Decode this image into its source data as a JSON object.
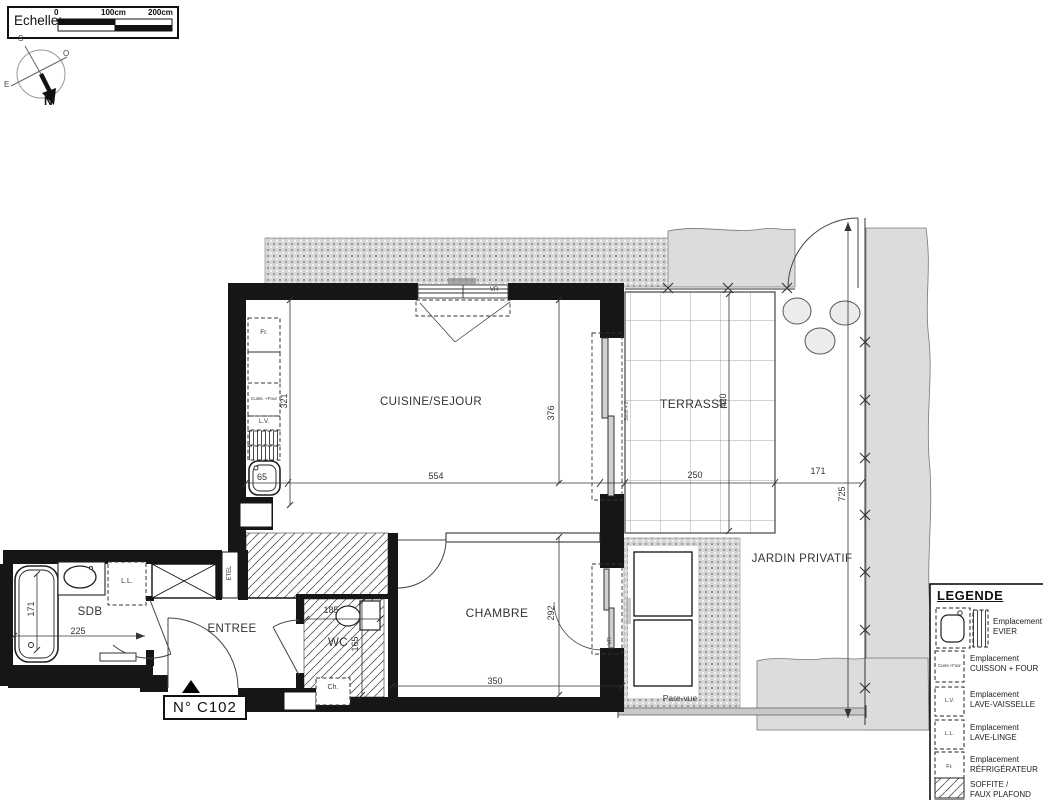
{
  "scale_widget": {
    "label": "Echelle:",
    "tick0": "0",
    "tick100": "100cm",
    "tick200": "200cm"
  },
  "compass": {
    "north": "N",
    "south": "S",
    "east": "E",
    "west": "O"
  },
  "unit_tag": {
    "number": "N° C102"
  },
  "rooms": {
    "cuisine_sejour": "CUISINE/SEJOUR",
    "terrasse": "TERRASSE",
    "chambre": "CHAMBRE",
    "wc": "WC",
    "entree": "ENTREE",
    "sdb": "SDB",
    "jardin_privatif": "JARDIN PRIVATIF"
  },
  "dims": {
    "kitchen_w": "554",
    "kitchen_h_left": "321",
    "kitchen_h_right": "376",
    "sink_w": "65",
    "terrasse_w": "250",
    "terrasse_h": "420",
    "jardin_w": "171",
    "jardin_h": "725",
    "chambre_w": "350",
    "chambre_h": "292",
    "wc_w": "185",
    "wc_h": "165",
    "sdb_w": "225",
    "bath_l": "171"
  },
  "annotations": {
    "fridge": "Fr.",
    "hob_oven": "Cuiss. +Four",
    "dishwasher": "L.V.",
    "washer": "L.L.",
    "etel": "ETEL",
    "boiler": "Ch.",
    "shutter": "VR",
    "threshold": "Seuil + 2",
    "screen": "Pare-vue"
  },
  "legend": {
    "title": "LEGENDE",
    "items": [
      {
        "id": "evier",
        "line1": "Emplacement",
        "line2": "EVIER"
      },
      {
        "id": "cuisson",
        "line1": "Emplacement",
        "line2": "CUISSON + FOUR"
      },
      {
        "id": "lave_vaisselle",
        "line1": "Emplacement",
        "line2": "LAVE-VAISSELLE"
      },
      {
        "id": "lave_linge",
        "line1": "Emplacement",
        "line2": "LAVE-LINGE"
      },
      {
        "id": "refrigerateur",
        "line1": "Emplacement",
        "line2": "RÉFRIGÉRATEUR"
      },
      {
        "id": "soffite",
        "line1": "SOFFITE /",
        "line2": "FAUX PLAFOND"
      }
    ],
    "mini": {
      "cuisson": "Cuiss.+Four",
      "lv": "L.V.",
      "ll": "L.L.",
      "fr": "Fr."
    }
  },
  "colors": {
    "wall": "#161616",
    "paving_gray": "#dcdcdc",
    "line": "#333333"
  }
}
